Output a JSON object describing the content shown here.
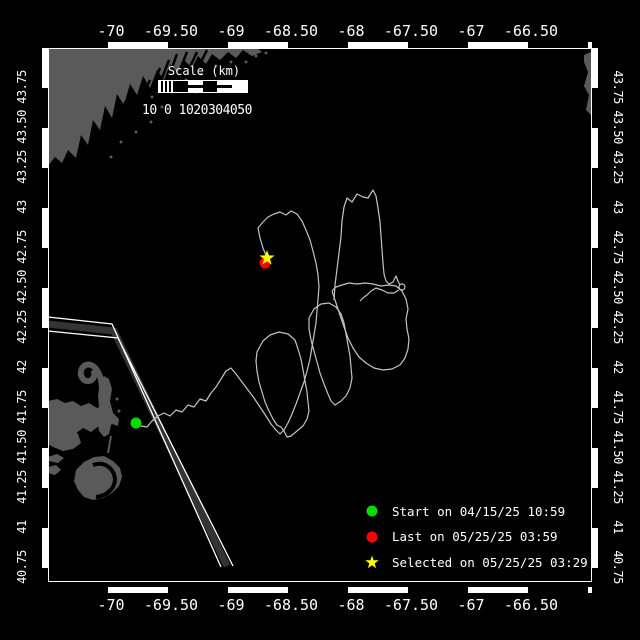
{
  "colors": {
    "background": "#000000",
    "land": "#5a5a5a",
    "lane": "#343434",
    "track": "#c4c4c4",
    "frame": "#ffffff",
    "text": "#ffffff",
    "start_green": "#00dd00",
    "last_red": "#ff0000",
    "selected_yellow": "#ffff00"
  },
  "axes": {
    "lon_labels": [
      "-70",
      "-69.50",
      "-69",
      "-68.50",
      "-68",
      "-67.50",
      "-67",
      "-66.50"
    ],
    "lat_labels": [
      "43.75",
      "43.50",
      "43.25",
      "43",
      "42.75",
      "42.50",
      "42.25",
      "42",
      "41.75",
      "41.50",
      "41.25",
      "41",
      "40.75"
    ]
  },
  "scale_bar": {
    "title": "Scale (km)",
    "labels": "10 0 1020304050"
  },
  "legend": [
    {
      "marker": "circle",
      "color": "#00dd00",
      "label": "Start on 04/15/25 10:59"
    },
    {
      "marker": "circle",
      "color": "#ff0000",
      "label": "Last on 05/25/25 03:59"
    },
    {
      "marker": "star",
      "color": "#ffff00",
      "label": "Selected on 05/25/25 03:29"
    }
  ],
  "markers": {
    "start": {
      "x": 136,
      "y": 423
    },
    "last": {
      "x": 265,
      "y": 263
    },
    "selected": {
      "x": 267,
      "y": 258
    }
  },
  "map": {
    "track": [
      [
        [
          136,
          423
        ],
        [
          141,
          426
        ],
        [
          147,
          427
        ],
        [
          152,
          421
        ],
        [
          158,
          416
        ],
        [
          164,
          413
        ],
        [
          170,
          416
        ],
        [
          176,
          410
        ],
        [
          182,
          412
        ],
        [
          188,
          405
        ],
        [
          194,
          407
        ],
        [
          200,
          399
        ],
        [
          206,
          401
        ],
        [
          211,
          393
        ],
        [
          216,
          387
        ],
        [
          221,
          379
        ],
        [
          226,
          371
        ],
        [
          231,
          368
        ],
        [
          236,
          374
        ],
        [
          242,
          382
        ],
        [
          248,
          390
        ],
        [
          254,
          398
        ],
        [
          260,
          407
        ],
        [
          266,
          416
        ],
        [
          271,
          424
        ],
        [
          276,
          430
        ],
        [
          280,
          434
        ],
        [
          284,
          430
        ],
        [
          288,
          423
        ],
        [
          292,
          414
        ],
        [
          296,
          404
        ],
        [
          300,
          393
        ],
        [
          304,
          382
        ],
        [
          307,
          371
        ],
        [
          310,
          359
        ],
        [
          312,
          347
        ],
        [
          314,
          335
        ],
        [
          316,
          323
        ],
        [
          317,
          311
        ],
        [
          318,
          299
        ],
        [
          319,
          287
        ],
        [
          318,
          275
        ],
        [
          316,
          263
        ],
        [
          313,
          251
        ],
        [
          310,
          240
        ],
        [
          306,
          230
        ],
        [
          302,
          221
        ],
        [
          297,
          214
        ],
        [
          291,
          211
        ],
        [
          286,
          215
        ],
        [
          280,
          212
        ],
        [
          274,
          214
        ],
        [
          268,
          217
        ],
        [
          263,
          222
        ],
        [
          258,
          228
        ],
        [
          260,
          238
        ],
        [
          263,
          248
        ],
        [
          267,
          258
        ]
      ],
      [
        [
          258,
          350
        ],
        [
          263,
          341
        ],
        [
          270,
          335
        ],
        [
          279,
          332
        ],
        [
          288,
          334
        ],
        [
          295,
          340
        ],
        [
          298,
          349
        ],
        [
          301,
          359
        ],
        [
          303,
          370
        ],
        [
          305,
          381
        ],
        [
          307,
          392
        ],
        [
          308,
          402
        ],
        [
          309,
          411
        ],
        [
          307,
          419
        ],
        [
          303,
          426
        ],
        [
          297,
          431
        ],
        [
          291,
          436
        ],
        [
          287,
          437
        ],
        [
          284,
          431
        ],
        [
          281,
          427
        ],
        [
          277,
          425
        ],
        [
          273,
          419
        ],
        [
          269,
          411
        ],
        [
          265,
          402
        ],
        [
          262,
          392
        ],
        [
          259,
          382
        ],
        [
          257,
          371
        ],
        [
          256,
          361
        ],
        [
          257,
          352
        ],
        [
          258,
          350
        ]
      ],
      [
        [
          309,
          318
        ],
        [
          314,
          309
        ],
        [
          321,
          304
        ],
        [
          329,
          303
        ],
        [
          336,
          307
        ],
        [
          341,
          314
        ],
        [
          344,
          323
        ],
        [
          346,
          334
        ],
        [
          348,
          345
        ],
        [
          350,
          356
        ],
        [
          351,
          367
        ],
        [
          352,
          378
        ],
        [
          350,
          388
        ],
        [
          346,
          396
        ],
        [
          341,
          401
        ],
        [
          335,
          405
        ],
        [
          331,
          401
        ],
        [
          328,
          394
        ],
        [
          324,
          384
        ],
        [
          320,
          373
        ],
        [
          317,
          362
        ],
        [
          314,
          351
        ],
        [
          311,
          340
        ],
        [
          309,
          329
        ],
        [
          309,
          318
        ]
      ],
      [
        [
          332,
          291
        ],
        [
          336,
          303
        ],
        [
          340,
          315
        ],
        [
          344,
          327
        ],
        [
          348,
          338
        ],
        [
          353,
          348
        ],
        [
          359,
          357
        ],
        [
          366,
          363
        ],
        [
          374,
          368
        ],
        [
          383,
          370
        ],
        [
          392,
          369
        ],
        [
          400,
          365
        ],
        [
          405,
          358
        ],
        [
          408,
          349
        ],
        [
          409,
          339
        ],
        [
          407,
          329
        ],
        [
          406,
          319
        ],
        [
          408,
          309
        ],
        [
          406,
          299
        ],
        [
          402,
          291
        ],
        [
          396,
          286
        ],
        [
          389,
          285
        ],
        [
          381,
          286
        ],
        [
          373,
          284
        ],
        [
          365,
          283
        ],
        [
          357,
          284
        ],
        [
          349,
          283
        ],
        [
          342,
          285
        ],
        [
          336,
          287
        ],
        [
          332,
          291
        ]
      ],
      [
        [
          334,
          300
        ],
        [
          335,
          285
        ],
        [
          337,
          269
        ],
        [
          339,
          253
        ],
        [
          341,
          237
        ],
        [
          342,
          221
        ],
        [
          344,
          207
        ],
        [
          347,
          198
        ],
        [
          352,
          202
        ],
        [
          357,
          194
        ],
        [
          363,
          197
        ],
        [
          368,
          198
        ],
        [
          373,
          190
        ],
        [
          376,
          196
        ],
        [
          378,
          208
        ],
        [
          380,
          222
        ],
        [
          381,
          236
        ],
        [
          382,
          250
        ],
        [
          383,
          263
        ],
        [
          384,
          274
        ],
        [
          386,
          281
        ],
        [
          389,
          284
        ],
        [
          393,
          282
        ],
        [
          396,
          276
        ],
        [
          398,
          281
        ],
        [
          400,
          285
        ]
      ],
      [
        [
          399,
          290
        ],
        [
          394,
          293
        ],
        [
          388,
          293
        ],
        [
          382,
          290
        ],
        [
          376,
          288
        ],
        [
          371,
          291
        ],
        [
          367,
          295
        ],
        [
          363,
          298
        ],
        [
          360,
          301
        ]
      ]
    ],
    "knot": {
      "x": 402,
      "y": 287,
      "r": 3
    }
  }
}
